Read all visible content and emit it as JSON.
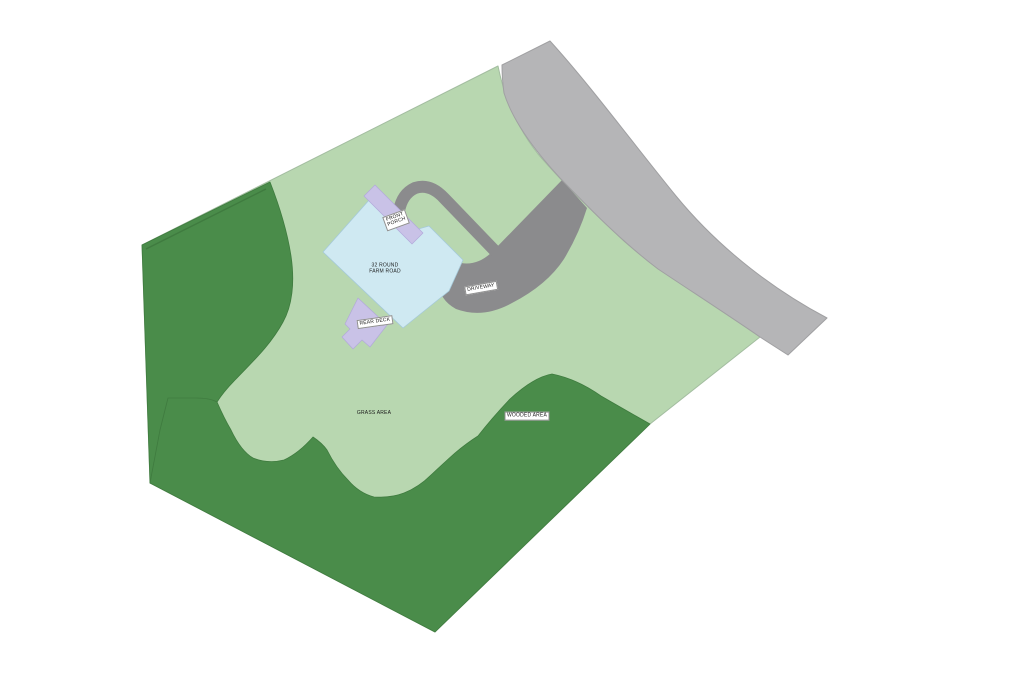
{
  "plan": {
    "title": "Residential site plan",
    "labels": {
      "house": "32 ROUND\nFARM ROAD",
      "front_porch": "FRONT\nPORCH",
      "rear_deck": "REAR DECK",
      "driveway": "DRIVEWAY",
      "grass": "GRASS AREA",
      "wooded": "WOODED AREA"
    },
    "colors": {
      "background": "#ffffff",
      "grass": "#b8d7b0",
      "grass_edge": "#a3bda0",
      "woods": "#4a8c4a",
      "woods_edge": "#3f7b3f",
      "road": "#b5b5b7",
      "road_edge": "#a0a0a2",
      "driveway": "#8b8b8d",
      "house": "#cfe9f2",
      "house_edge": "#a5c9d9",
      "deck": "#c9c2e7",
      "deck_edge": "#b2a9da",
      "label_text": "#1a1a1a",
      "label_bg": "#ffffff"
    }
  }
}
